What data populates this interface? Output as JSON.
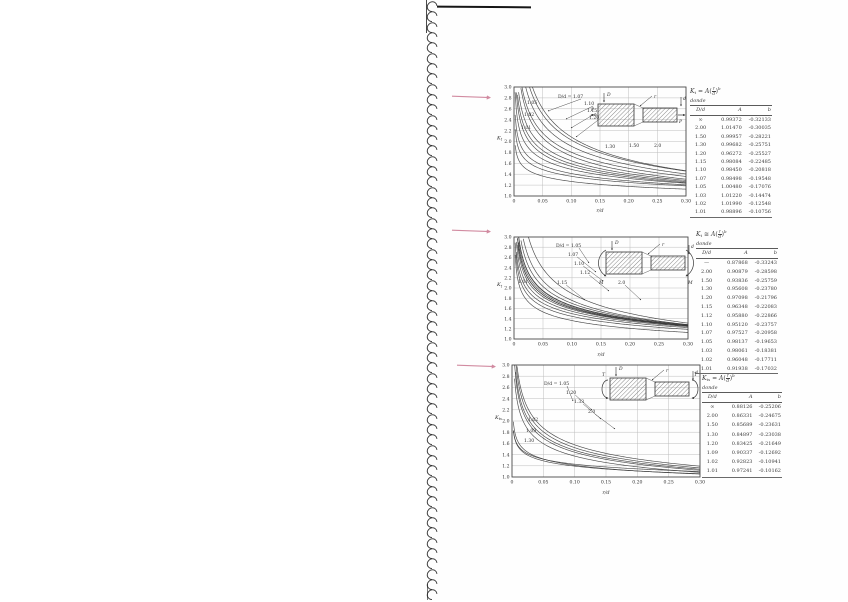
{
  "page": {
    "type": "scanned-textbook-page",
    "paper_color": "#fefefe",
    "ink_color": "#3a3a3a",
    "binding": {
      "coil_count": 58
    },
    "margin_arrows": {
      "color": "#c76f8a",
      "items": [
        {
          "x": 451,
          "y": 93
        },
        {
          "x": 451,
          "y": 227
        },
        {
          "x": 456,
          "y": 362
        }
      ]
    }
  },
  "charts": [
    {
      "formula": {
        "lhs_main": "K",
        "lhs_sub": "t",
        "rel": "=",
        "coef": "A",
        "open": "(",
        "num": "r",
        "den": "d",
        "close": ")",
        "exp": "b"
      },
      "where": "donde",
      "columns": [
        "D/d",
        "A",
        "b"
      ],
      "inset": {
        "outer_dim": "D",
        "inner_dim": "d",
        "fillet": "r",
        "load": "P"
      }
    },
    {
      "formula": {
        "lhs_main": "K",
        "lhs_sub": "t",
        "rel": "≅",
        "coef": "A",
        "open": "(",
        "num": "r",
        "den": "d",
        "close": ")",
        "exp": "b"
      },
      "where": "donde",
      "columns": [
        "D/d",
        "A",
        "b"
      ],
      "inset": {
        "outer_dim": "D",
        "inner_dim": "d",
        "fillet": "r",
        "load": "M"
      }
    },
    {
      "formula": {
        "lhs_main": "K",
        "lhs_sub": "ts",
        "rel": "=",
        "coef": "A",
        "open": "(",
        "num": "r",
        "den": "d",
        "close": ")",
        "exp": "b"
      },
      "where": "donde",
      "columns": [
        "D/d",
        "A",
        "b"
      ],
      "inset": {
        "outer_dim": "D",
        "inner_dim": "d",
        "fillet": "r",
        "load": "T"
      }
    }
  ],
  "chart_data": [
    {
      "type": "line",
      "name": "axial-tension-stress-concentration",
      "model": "Kt = A*(r/d)^b",
      "load": "axial",
      "xlabel": "r/d",
      "ylabel": "Kt",
      "xlim": [
        0,
        0.3
      ],
      "ylim": [
        1.0,
        3.0
      ],
      "grid": true,
      "xticks": [
        "0",
        "0.05",
        "0.10",
        "0.15",
        "0.20",
        "0.25",
        "0.30"
      ],
      "yticks": [
        "3.0",
        "2.8",
        "2.6",
        "2.4",
        "2.2",
        "2.0",
        "1.8",
        "1.6",
        "1.4",
        "1.2",
        "1.0"
      ],
      "series": [
        {
          "name": "∞",
          "A": "0.99372",
          "b": "-0.32133"
        },
        {
          "name": "2.00",
          "A": "1.01470",
          "b": "-0.30035"
        },
        {
          "name": "1.50",
          "A": "0.99957",
          "b": "-0.28221"
        },
        {
          "name": "1.30",
          "A": "0.99682",
          "b": "-0.25751"
        },
        {
          "name": "1.20",
          "A": "0.96272",
          "b": "-0.25527"
        },
        {
          "name": "1.15",
          "A": "0.98084",
          "b": "-0.22485"
        },
        {
          "name": "1.10",
          "A": "0.98450",
          "b": "-0.20818"
        },
        {
          "name": "1.07",
          "A": "0.98498",
          "b": "-0.19548"
        },
        {
          "name": "1.05",
          "A": "1.00480",
          "b": "-0.17076"
        },
        {
          "name": "1.03",
          "A": "1.01220",
          "b": "-0.14474"
        },
        {
          "name": "1.02",
          "A": "1.01990",
          "b": "-0.12548"
        },
        {
          "name": "1.01",
          "A": "0.98896",
          "b": "-0.10756"
        }
      ],
      "annotations": [
        {
          "text": "D/d = 1.07",
          "x": 558,
          "y": 98,
          "leader": [
            548,
            111
          ]
        },
        {
          "text": "1.10",
          "x": 584,
          "y": 105,
          "leader": [
            566,
            119
          ]
        },
        {
          "text": "1.15",
          "x": 587,
          "y": 112,
          "leader": [
            571,
            128
          ]
        },
        {
          "text": "1.20",
          "x": 589,
          "y": 119,
          "leader": [
            576,
            137
          ]
        },
        {
          "text": "1.30",
          "x": 605,
          "y": 148,
          "leader": null
        },
        {
          "text": "1.50",
          "x": 629,
          "y": 147,
          "leader": null
        },
        {
          "text": "2.0",
          "x": 654,
          "y": 147,
          "leader": null
        },
        {
          "text": "1.05",
          "x": 527,
          "y": 104,
          "leader": null
        },
        {
          "text": "1.02",
          "x": 524,
          "y": 116,
          "leader": null
        },
        {
          "text": "1.01",
          "x": 521,
          "y": 129,
          "leader": null
        }
      ]
    },
    {
      "type": "line",
      "name": "bending-stress-concentration",
      "model": "Kt = A*(r/d)^b",
      "load": "bending",
      "xlabel": "r/d",
      "ylabel": "Kt",
      "xlim": [
        0,
        0.3
      ],
      "ylim": [
        1.0,
        3.0
      ],
      "grid": true,
      "xticks": [
        "0",
        "0.05",
        "0.10",
        "0.15",
        "0.20",
        "0.25",
        "0.30"
      ],
      "yticks": [
        "3.0",
        "2.8",
        "2.6",
        "2.4",
        "2.2",
        "2.0",
        "1.8",
        "1.6",
        "1.4",
        "1.2",
        "1.0"
      ],
      "series": [
        {
          "name": "—",
          "A": "0.87868",
          "b": "-0.33243"
        },
        {
          "name": "2.00",
          "A": "0.90879",
          "b": "-0.28598"
        },
        {
          "name": "1.50",
          "A": "0.93836",
          "b": "-0.25759"
        },
        {
          "name": "1.30",
          "A": "0.95608",
          "b": "-0.23780"
        },
        {
          "name": "1.20",
          "A": "0.97098",
          "b": "-0.21796"
        },
        {
          "name": "1.15",
          "A": "0.96348",
          "b": "-0.22083"
        },
        {
          "name": "1.12",
          "A": "0.95880",
          "b": "-0.22866"
        },
        {
          "name": "1.10",
          "A": "0.95120",
          "b": "-0.23757"
        },
        {
          "name": "1.07",
          "A": "0.97527",
          "b": "-0.20958"
        },
        {
          "name": "1.05",
          "A": "0.98137",
          "b": "-0.19653"
        },
        {
          "name": "1.03",
          "A": "0.98061",
          "b": "-0.18381"
        },
        {
          "name": "1.02",
          "A": "0.96048",
          "b": "-0.17711"
        },
        {
          "name": "1.01",
          "A": "0.91938",
          "b": "-0.17032"
        }
      ],
      "annotations": [
        {
          "text": "D/d = 1.05",
          "x": 556,
          "y": 247,
          "leader": [
            589,
            263
          ]
        },
        {
          "text": "1.07",
          "x": 568,
          "y": 256,
          "leader": [
            596,
            272
          ]
        },
        {
          "text": "1.10",
          "x": 574,
          "y": 265,
          "leader": [
            603,
            281
          ]
        },
        {
          "text": "1.12",
          "x": 580,
          "y": 274,
          "leader": [
            609,
            291
          ]
        },
        {
          "text": "1.15",
          "x": 557,
          "y": 284,
          "leader": [
            585,
            300
          ]
        },
        {
          "text": "2.0",
          "x": 618,
          "y": 284,
          "leader": [
            641,
            300
          ]
        },
        {
          "text": "1.01",
          "x": 518,
          "y": 283,
          "leader": null
        }
      ]
    },
    {
      "type": "line",
      "name": "torsion-stress-concentration",
      "model": "Kts = A*(r/d)^b",
      "load": "torsion",
      "xlabel": "r/d",
      "ylabel": "Kts",
      "xlim": [
        0,
        0.3
      ],
      "ylim": [
        1.0,
        3.0
      ],
      "grid": true,
      "xticks": [
        "0",
        "0.05",
        "0.10",
        "0.15",
        "0.20",
        "0.25",
        "0.30"
      ],
      "yticks": [
        "3.0",
        "2.8",
        "2.6",
        "2.4",
        "2.2",
        "2.0",
        "1.8",
        "1.6",
        "1.4",
        "1.2",
        "1.0"
      ],
      "series": [
        {
          "name": "∞",
          "A": "0.88126",
          "b": "-0.25206"
        },
        {
          "name": "2.00",
          "A": "0.86331",
          "b": "-0.24675"
        },
        {
          "name": "1.50",
          "A": "0.85689",
          "b": "-0.23631"
        },
        {
          "name": "1.30",
          "A": "0.84897",
          "b": "-0.23038"
        },
        {
          "name": "1.20",
          "A": "0.83425",
          "b": "-0.21649"
        },
        {
          "name": "1.09",
          "A": "0.90337",
          "b": "-0.12692"
        },
        {
          "name": "1.02",
          "A": "0.92823",
          "b": "-0.10941"
        },
        {
          "name": "1.01",
          "A": "0.97241",
          "b": "-0.10162"
        }
      ],
      "annotations": [
        {
          "text": "D/d = 1.05",
          "x": 544,
          "y": 385,
          "leader": [
            573,
            401
          ]
        },
        {
          "text": "1.20",
          "x": 566,
          "y": 394,
          "leader": [
            592,
            410
          ]
        },
        {
          "text": "1.33",
          "x": 574,
          "y": 403,
          "leader": [
            601,
            419
          ]
        },
        {
          "text": "2.0",
          "x": 588,
          "y": 413,
          "leader": [
            615,
            429
          ]
        },
        {
          "text": "1.02",
          "x": 528,
          "y": 421,
          "leader": null
        },
        {
          "text": "1.09",
          "x": 526,
          "y": 432,
          "leader": null
        },
        {
          "text": "1.30",
          "x": 524,
          "y": 442,
          "leader": null
        }
      ]
    }
  ]
}
